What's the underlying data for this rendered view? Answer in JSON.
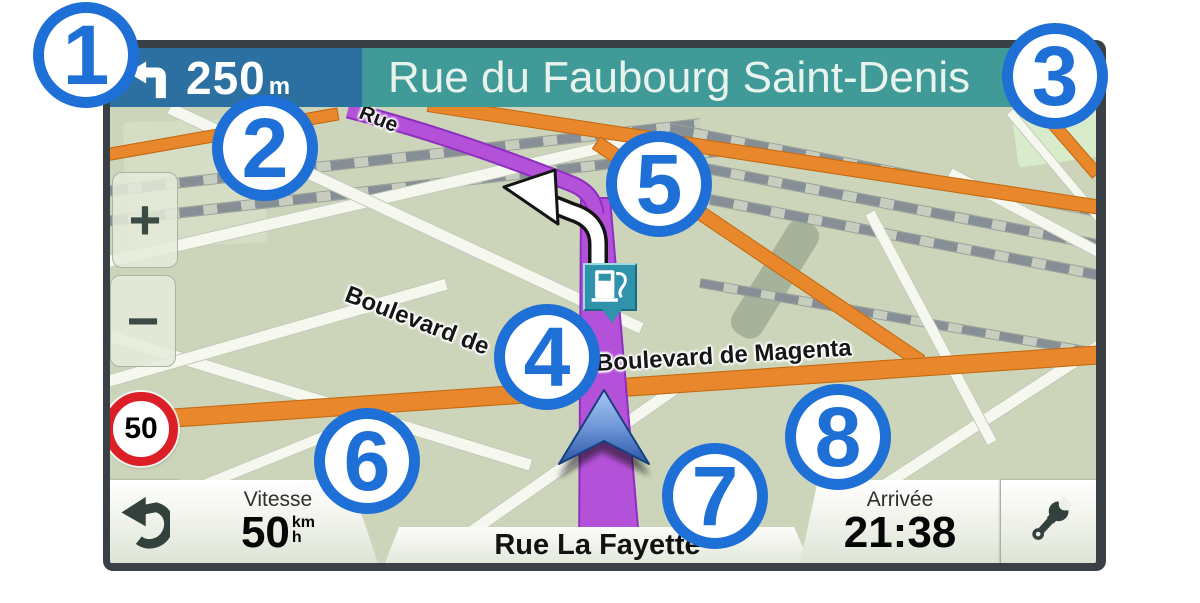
{
  "top_bar": {
    "distance": "250",
    "distance_unit": "m",
    "next_street": "Rue du Faubourg Saint-Denis"
  },
  "map": {
    "street_labels": {
      "rue": "Rue",
      "boulevard_de": "Boulevard de",
      "boulevard_magenta": "Boulevard de Magenta"
    },
    "speed_limit": "50",
    "zoom_in": "+",
    "zoom_out": "−"
  },
  "bottom_bar": {
    "speed": {
      "label": "Vitesse",
      "value": "50",
      "unit_top": "km",
      "unit_bottom": "h"
    },
    "current_street": "Rue La Fayette",
    "arrival": {
      "label": "Arrivée",
      "value": "21:38"
    }
  },
  "callouts": [
    "1",
    "2",
    "3",
    "4",
    "5",
    "6",
    "7",
    "8"
  ],
  "icons": {
    "next_turn": "turn-left-arrow-icon",
    "back": "back-arrow-icon",
    "tools": "wrench-icon",
    "zoom_in": "plus-icon",
    "zoom_out": "minus-icon",
    "poi": "fuel-pump-icon",
    "position": "vehicle-arrow-icon",
    "maneuver": "route-turn-arrow-icon"
  },
  "colors": {
    "accent_blue": "#1e70d6",
    "route_purple": "#b352d8",
    "road_orange": "#e8872b",
    "bar_blue": "#2c70a1",
    "bar_teal": "#3f9a98",
    "speed_red": "#dc1f26",
    "fuel_teal": "#2f93ac",
    "map_bg": "#ccd5ba"
  }
}
